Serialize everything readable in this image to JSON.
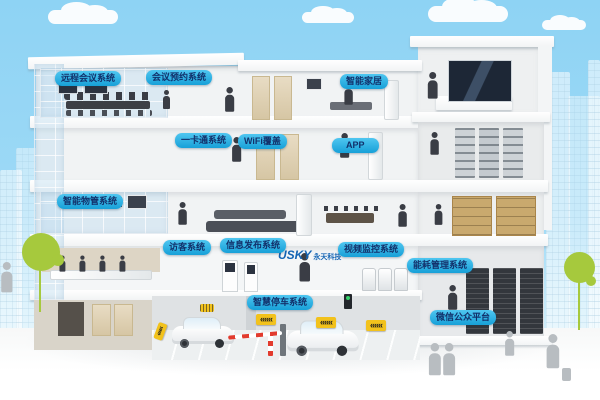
{
  "scene_title": "smart building systems cutaway illustration",
  "labels": [
    {
      "id": "remote-conference-system",
      "text": "远程会议系统"
    },
    {
      "id": "meeting-reservation-system",
      "text": "会议预约系统"
    },
    {
      "id": "smart-home",
      "text": "智能家居"
    },
    {
      "id": "one-card-system",
      "text": "一卡通系统"
    },
    {
      "id": "wifi-coverage",
      "text": "WiFi覆盖"
    },
    {
      "id": "app",
      "text": "APP"
    },
    {
      "id": "property-management-system",
      "text": "智能物管系统"
    },
    {
      "id": "visitor-system",
      "text": "访客系统"
    },
    {
      "id": "info-publishing-system",
      "text": "信息发布系统"
    },
    {
      "id": "video-surveillance-system",
      "text": "视频监控系统"
    },
    {
      "id": "energy-management-system",
      "text": "能耗管理系统"
    },
    {
      "id": "smart-parking-system",
      "text": "智慧停车系统"
    },
    {
      "id": "wechat-public-platform",
      "text": "微信公众平台"
    }
  ],
  "logo": {
    "main": "USKY",
    "sub": "永天科技"
  },
  "signs": {
    "chevron": "«««"
  },
  "colors": {
    "sky": "#8ed3f4",
    "label_gradient_top": "#4fc6f0",
    "label_gradient_bottom": "#17a0d8",
    "label_text": "#12316b",
    "logo_blue": "#1464b4",
    "tree_green": "#a6c93d",
    "sign_yellow": "#f2c21c",
    "building_white": "#ffffff",
    "silhouette_dark": "#3a3d45",
    "silhouette_gray": "#b8bdc1"
  }
}
